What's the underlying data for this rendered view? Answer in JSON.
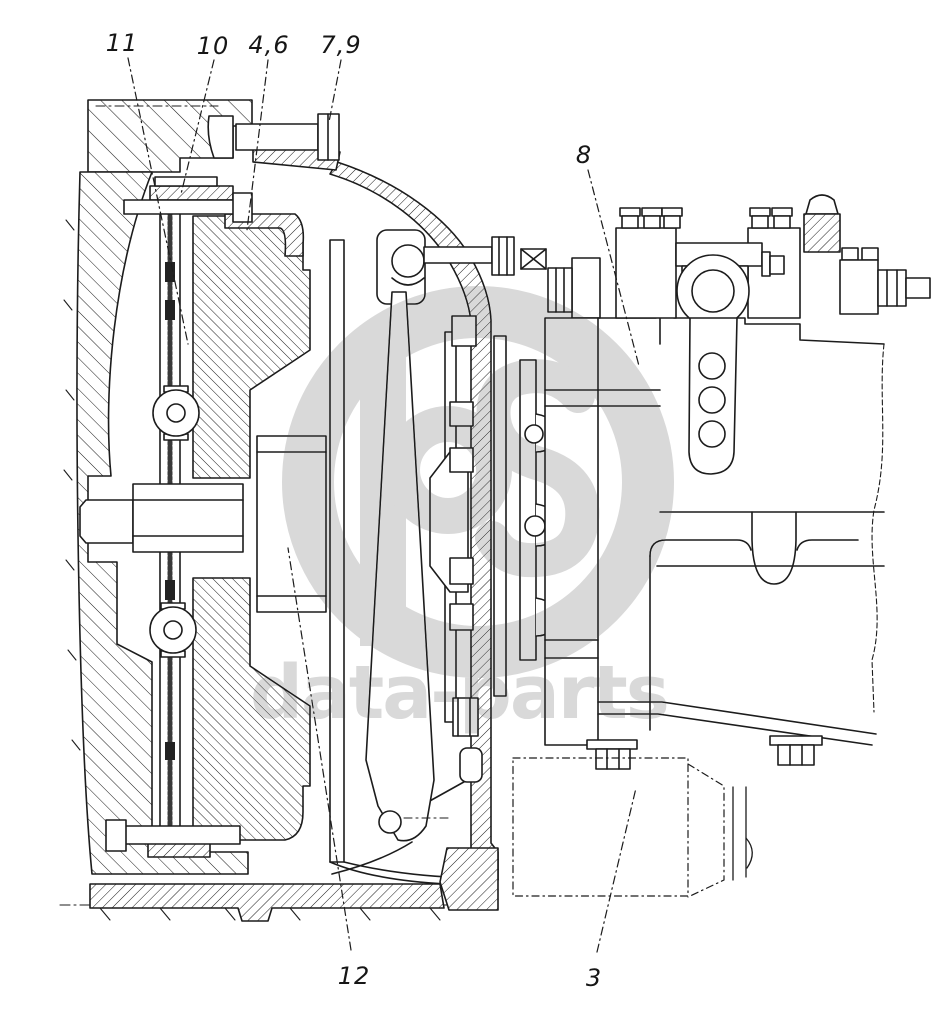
{
  "title": "Clutch and gearbox sectional diagram",
  "colors": {
    "line": "#1c1c1c",
    "watermark": "#d9d9d9",
    "background": "#ffffff"
  },
  "watermark": {
    "text": "data-parts"
  },
  "labels": [
    {
      "id": "11",
      "text": "11"
    },
    {
      "id": "10",
      "text": "10"
    },
    {
      "id": "4,6",
      "text": "4,6"
    },
    {
      "id": "7,9",
      "text": "7,9"
    },
    {
      "id": "8",
      "text": "8"
    },
    {
      "id": "12",
      "text": "12"
    },
    {
      "id": "3",
      "text": "3"
    }
  ]
}
